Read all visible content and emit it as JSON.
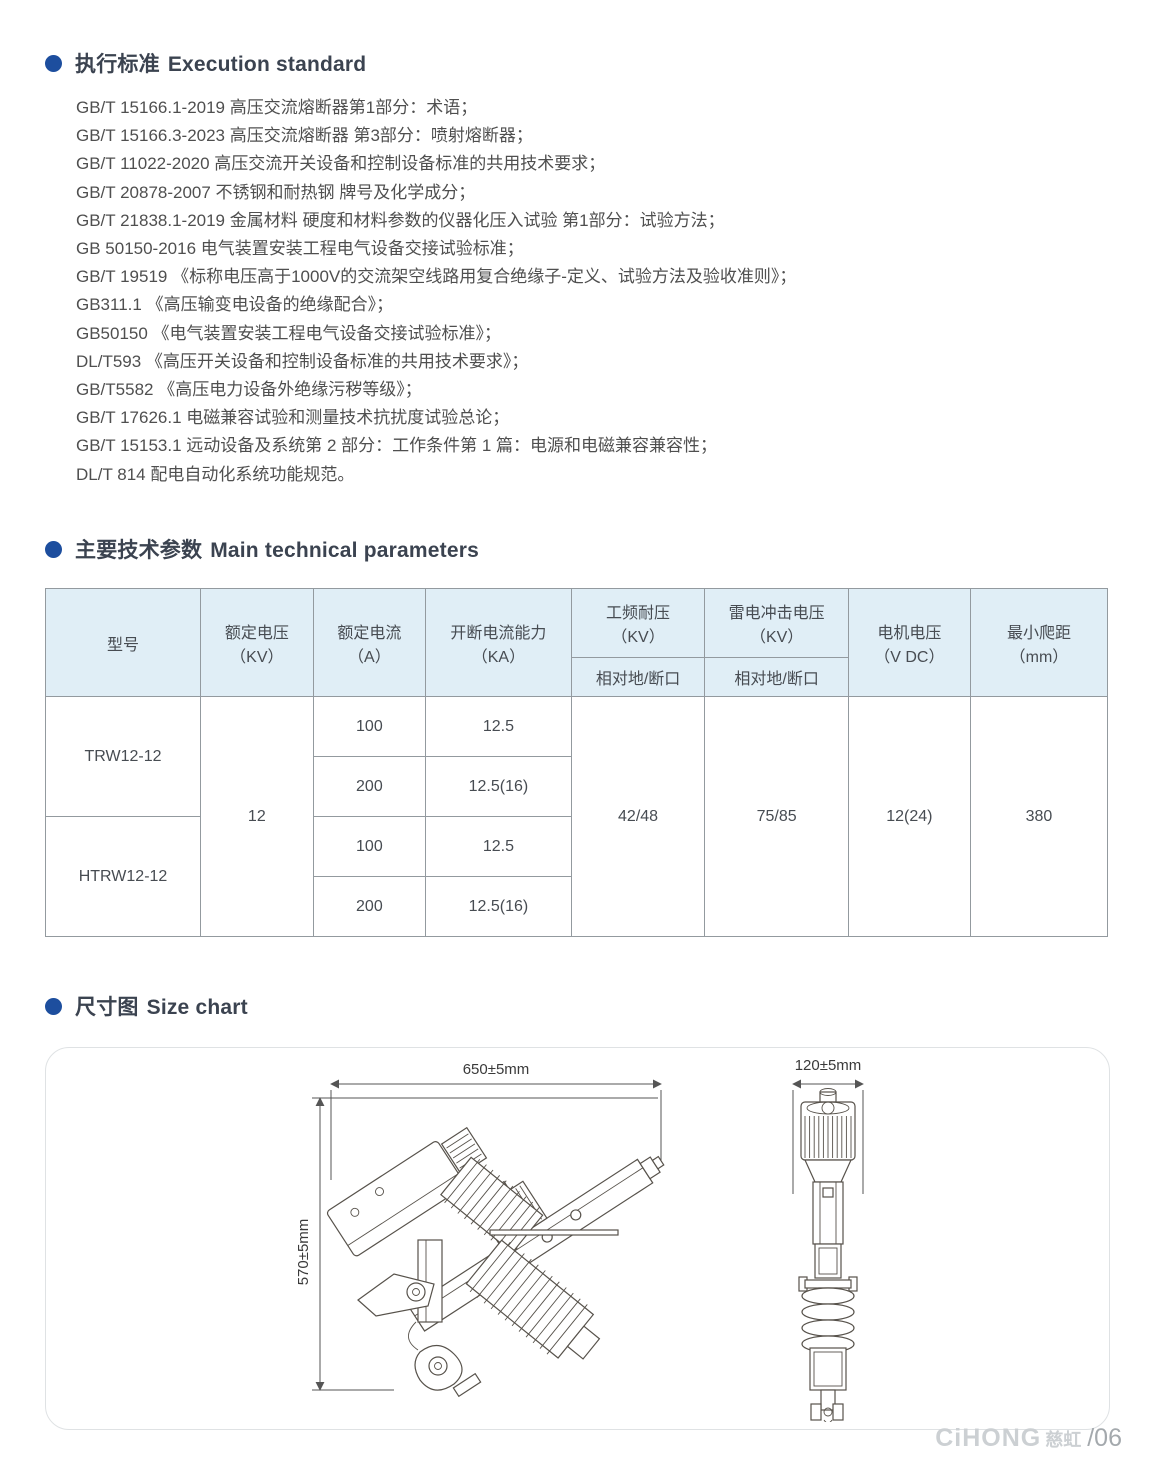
{
  "sections": {
    "standards": {
      "title_cn": "执行标准",
      "title_en": "Execution standard",
      "items": [
        "GB/T 15166.1-2019 高压交流熔断器第1部分：术语；",
        "GB/T 15166.3-2023 高压交流熔断器 第3部分：喷射熔断器；",
        "GB/T 11022-2020 高压交流开关设备和控制设备标准的共用技术要求；",
        "GB/T 20878-2007 不锈钢和耐热钢 牌号及化学成分；",
        "GB/T 21838.1-2019 金属材料 硬度和材料参数的仪器化压入试验 第1部分：试验方法；",
        "GB 50150-2016 电气装置安装工程电气设备交接试验标准；",
        "GB/T 19519 《标称电压高于1000V的交流架空线路用复合绝缘子-定义、试验方法及验收准则》；",
        "GB311.1 《高压输变电设备的绝缘配合》；",
        "GB50150 《电气装置安装工程电气设备交接试验标准》；",
        "DL/T593 《高压开关设备和控制设备标准的共用技术要求》；",
        "GB/T5582 《高压电力设备外绝缘污秽等级》；",
        "GB/T 17626.1 电磁兼容试验和测量技术抗扰度试验总论；",
        "GB/T 15153.1 远动设备及系统第 2 部分：工作条件第 1 篇：电源和电磁兼容兼容性；",
        "DL/T 814 配电自动化系统功能规范。"
      ]
    },
    "parameters": {
      "title_cn": "主要技术参数",
      "title_en": "Main technical parameters",
      "table": {
        "header": {
          "model": "型号",
          "rated_voltage": "额定电压\n（KV）",
          "rated_current": "额定电流\n（A）",
          "breaking_capacity": "开断电流能力\n（KA）",
          "power_freq_withstand": "工频耐压\n（KV）",
          "lightning_impulse": "雷电冲击电压\n（KV）",
          "phase_to_ground": "相对地/断口",
          "motor_voltage": "电机电压\n（V DC）",
          "min_creepage": "最小爬距\n（mm）"
        },
        "body": {
          "model_1": "TRW12-12",
          "model_2": "HTRW12-12",
          "rated_voltage": "12",
          "rows": [
            {
              "current": "100",
              "breaking": "12.5"
            },
            {
              "current": "200",
              "breaking": "12.5(16)"
            },
            {
              "current": "100",
              "breaking": "12.5"
            },
            {
              "current": "200",
              "breaking": "12.5(16)"
            }
          ],
          "power_freq": "42/48",
          "lightning": "75/85",
          "motor_voltage": "12(24)",
          "creepage": "380"
        }
      }
    },
    "size_chart": {
      "title_cn": "尺寸图",
      "title_en": "Size chart",
      "front_view": {
        "width_dim": "650±5mm",
        "height_dim": "570±5mm"
      },
      "side_view": {
        "width_dim": "120±5mm"
      }
    }
  },
  "footer": {
    "brand_en": "CiHONG",
    "brand_cn": "慈虹",
    "page_no": "/06"
  },
  "colors": {
    "accent_blue": "#1d4e9e",
    "table_header_bg": "#e0eef6",
    "table_border": "#939a9f"
  }
}
